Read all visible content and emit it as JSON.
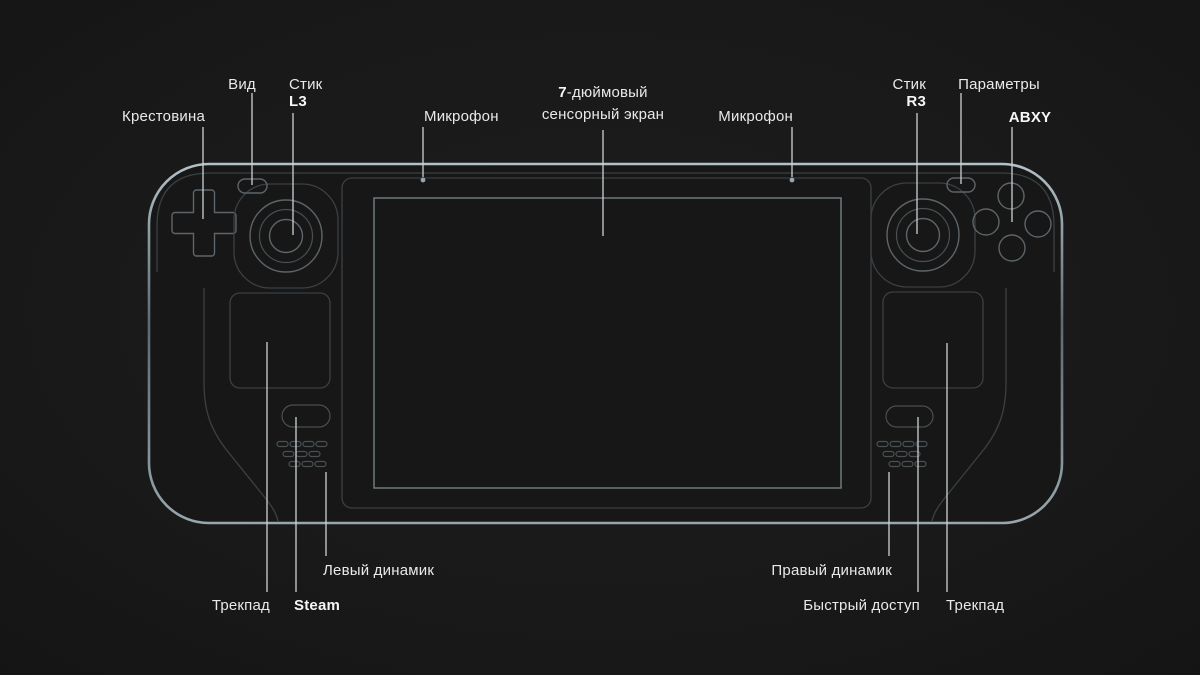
{
  "colors": {
    "bg": "#191919",
    "body-fill": "#171717",
    "edge-top": "#b4c1c8",
    "edge-mid": "#5d6a72",
    "edge-bottom": "#98a6ae",
    "dim": "#3a4043",
    "ctrl": "#5d656a",
    "ctrl-dim": "#494f53",
    "screen-stroke": "#6f797e",
    "panel-fill": "#141414",
    "screen-fill": "#101010",
    "leader": "#cdd1d3",
    "text": "#e9e9e9",
    "text-bold": "#f6f6f6"
  },
  "labels": {
    "krestovina": "Крестовина",
    "vid": "Вид",
    "stik": "Стик",
    "l3": "L3",
    "mic_left": "Микрофон",
    "screen_line1_bold": "7",
    "screen_line1_rest": "-дюймовый",
    "screen_line2": "сенсорный экран",
    "mic_right": "Микрофон",
    "r3": "R3",
    "parametry": "Параметры",
    "abxy": "ABXY",
    "left_speaker": "Левый динамик",
    "trackpad_left": "Трекпад",
    "steam": "Steam",
    "right_speaker": "Правый динамик",
    "quick_access": "Быстрый доступ",
    "trackpad_right": "Трекпад"
  }
}
